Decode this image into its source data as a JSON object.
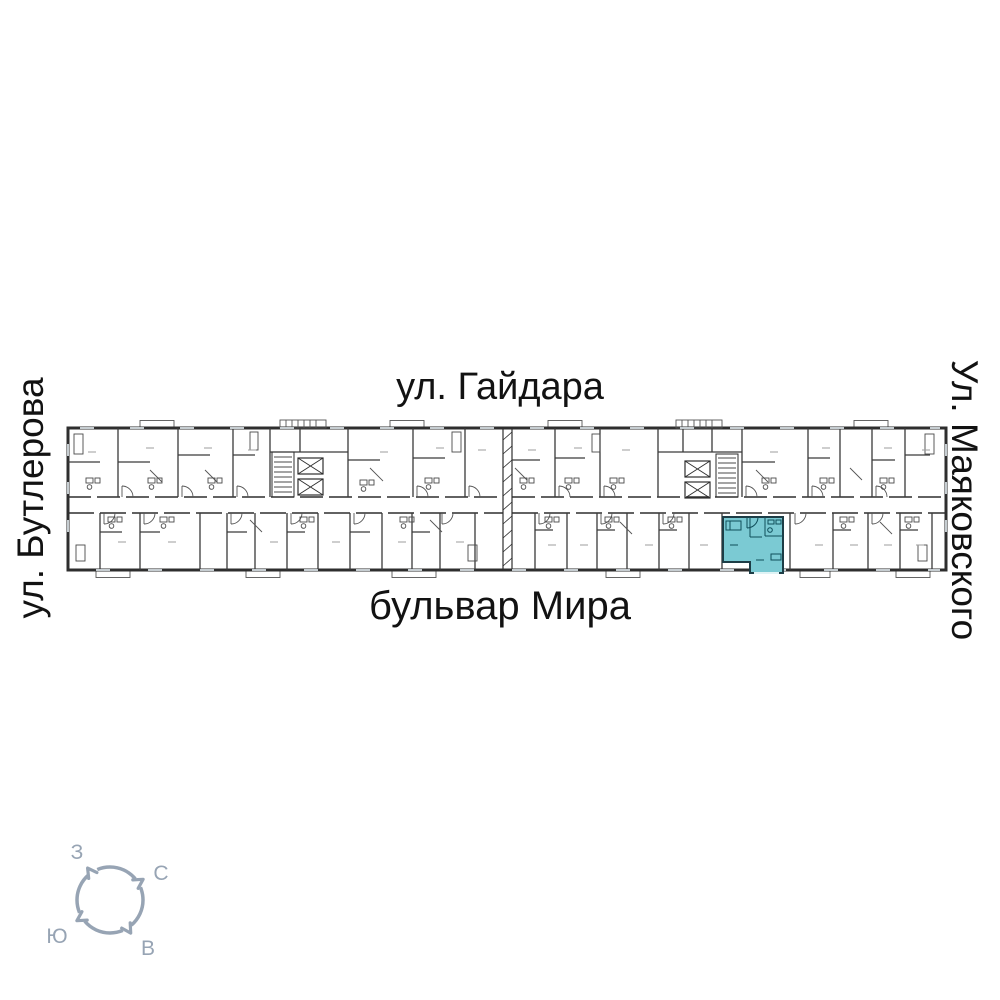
{
  "streets": {
    "top": "ул. Гайдара",
    "bottom": "бульвар Мира",
    "left": "ул. Бутлерова",
    "right": "Ул. Маяковского"
  },
  "compass": {
    "labels": {
      "west": "З",
      "north": "С",
      "south": "Ю",
      "east": "В"
    },
    "color": "#97a4b4"
  },
  "floorplan": {
    "wall_color": "#2e2e2e",
    "highlight_color": "#7bcad3",
    "sections_count": 2,
    "highlighted_unit": {
      "location": "bottom row of right section, facing бульвар Мира",
      "points": "723,517 783,517 783,573 750,573 750,562 723,562"
    }
  }
}
